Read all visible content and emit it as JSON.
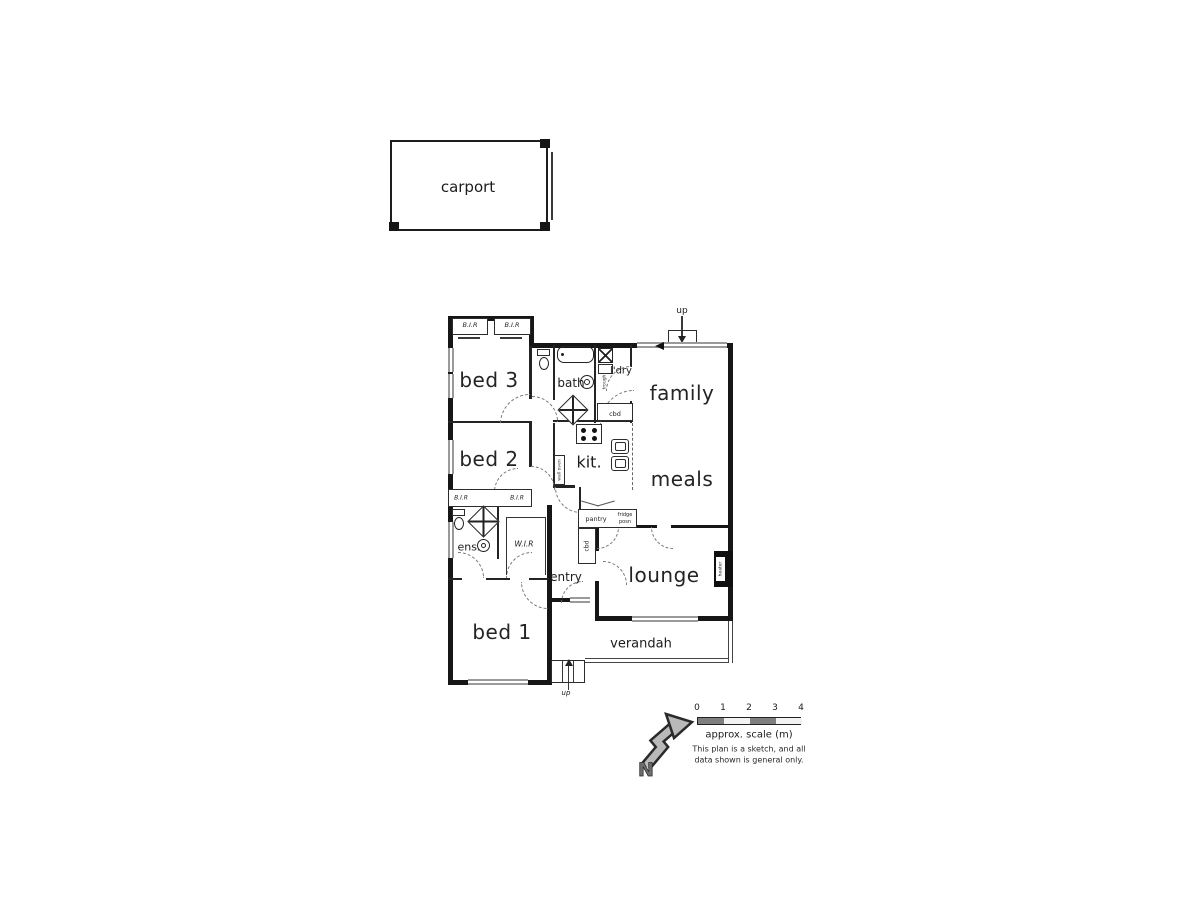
{
  "carport": {
    "label": "carport"
  },
  "rooms": {
    "bed3": "bed 3",
    "bed2": "bed 2",
    "bed1": "bed 1",
    "family": "family",
    "meals": "meals",
    "lounge": "lounge",
    "kit": "kit.",
    "bath": "bath",
    "ldry": "l'dry",
    "ens": "ens.",
    "wir": "W.I.R",
    "entry": "entry",
    "verandah": "verandah"
  },
  "storage": {
    "bir": "B.I.R",
    "cbd_top": "cbd",
    "cbd_hall": "cbd",
    "pantry": "pantry",
    "fridge_line1": "fridge",
    "fridge_line2": "posn"
  },
  "fixtures": {
    "heater": "heater",
    "trough": "trough",
    "wall_oven": "wall oven"
  },
  "stairs": {
    "up_top": "up",
    "up_bottom": "up"
  },
  "compass": {
    "north": "N"
  },
  "scalebar": {
    "tick0": "0",
    "tick1": "1",
    "tick2": "2",
    "tick3": "3",
    "tick4": "4",
    "caption": "approx. scale (m)",
    "note1": "This plan is a sketch, and all",
    "note2": "data shown is general only."
  },
  "colors": {
    "wall": "#161616",
    "window": "#9a9a9a",
    "scale_dark": "#7f7f7f"
  }
}
